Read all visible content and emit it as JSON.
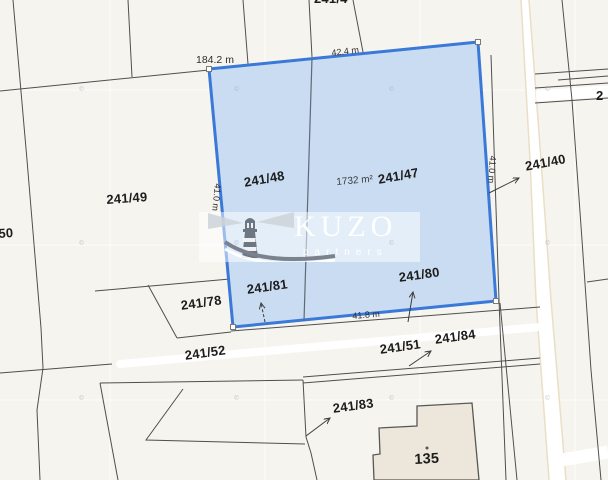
{
  "map": {
    "type": "cadastral-parcel-map",
    "selected": {
      "parcel_left": "241/48",
      "parcel_right": "241/47",
      "area_label": "1732 m²",
      "len_top": "42.4 m",
      "len_left": "41.0 m",
      "len_right": "41.0 m",
      "len_bottom": "41.8 m",
      "len_west_boundary": "184.2 m"
    },
    "labels": {
      "p49": "241/49",
      "p50": "50",
      "p40": "241/40",
      "p78": "241/78",
      "p81": "241/81",
      "p80": "241/80",
      "p52": "241/52",
      "p51": "241/51",
      "p84": "241/84",
      "p83": "241/83",
      "building": "135",
      "top_clipped": "241/4",
      "right_clipped": "2"
    },
    "watermark": {
      "brand": "KUZO",
      "subtitle": "partners",
      "tile_text": "©"
    },
    "colors": {
      "background": "#f6f4ee",
      "selection_fill": "#c9dcf2",
      "selection_border": "#3a79d8",
      "boundary_line": "#4f4f4f",
      "divider_line": "#5d6a77",
      "road_fill": "#ffffff",
      "road_edge": "#eadfc6",
      "building_fill": "#ede6db"
    }
  }
}
